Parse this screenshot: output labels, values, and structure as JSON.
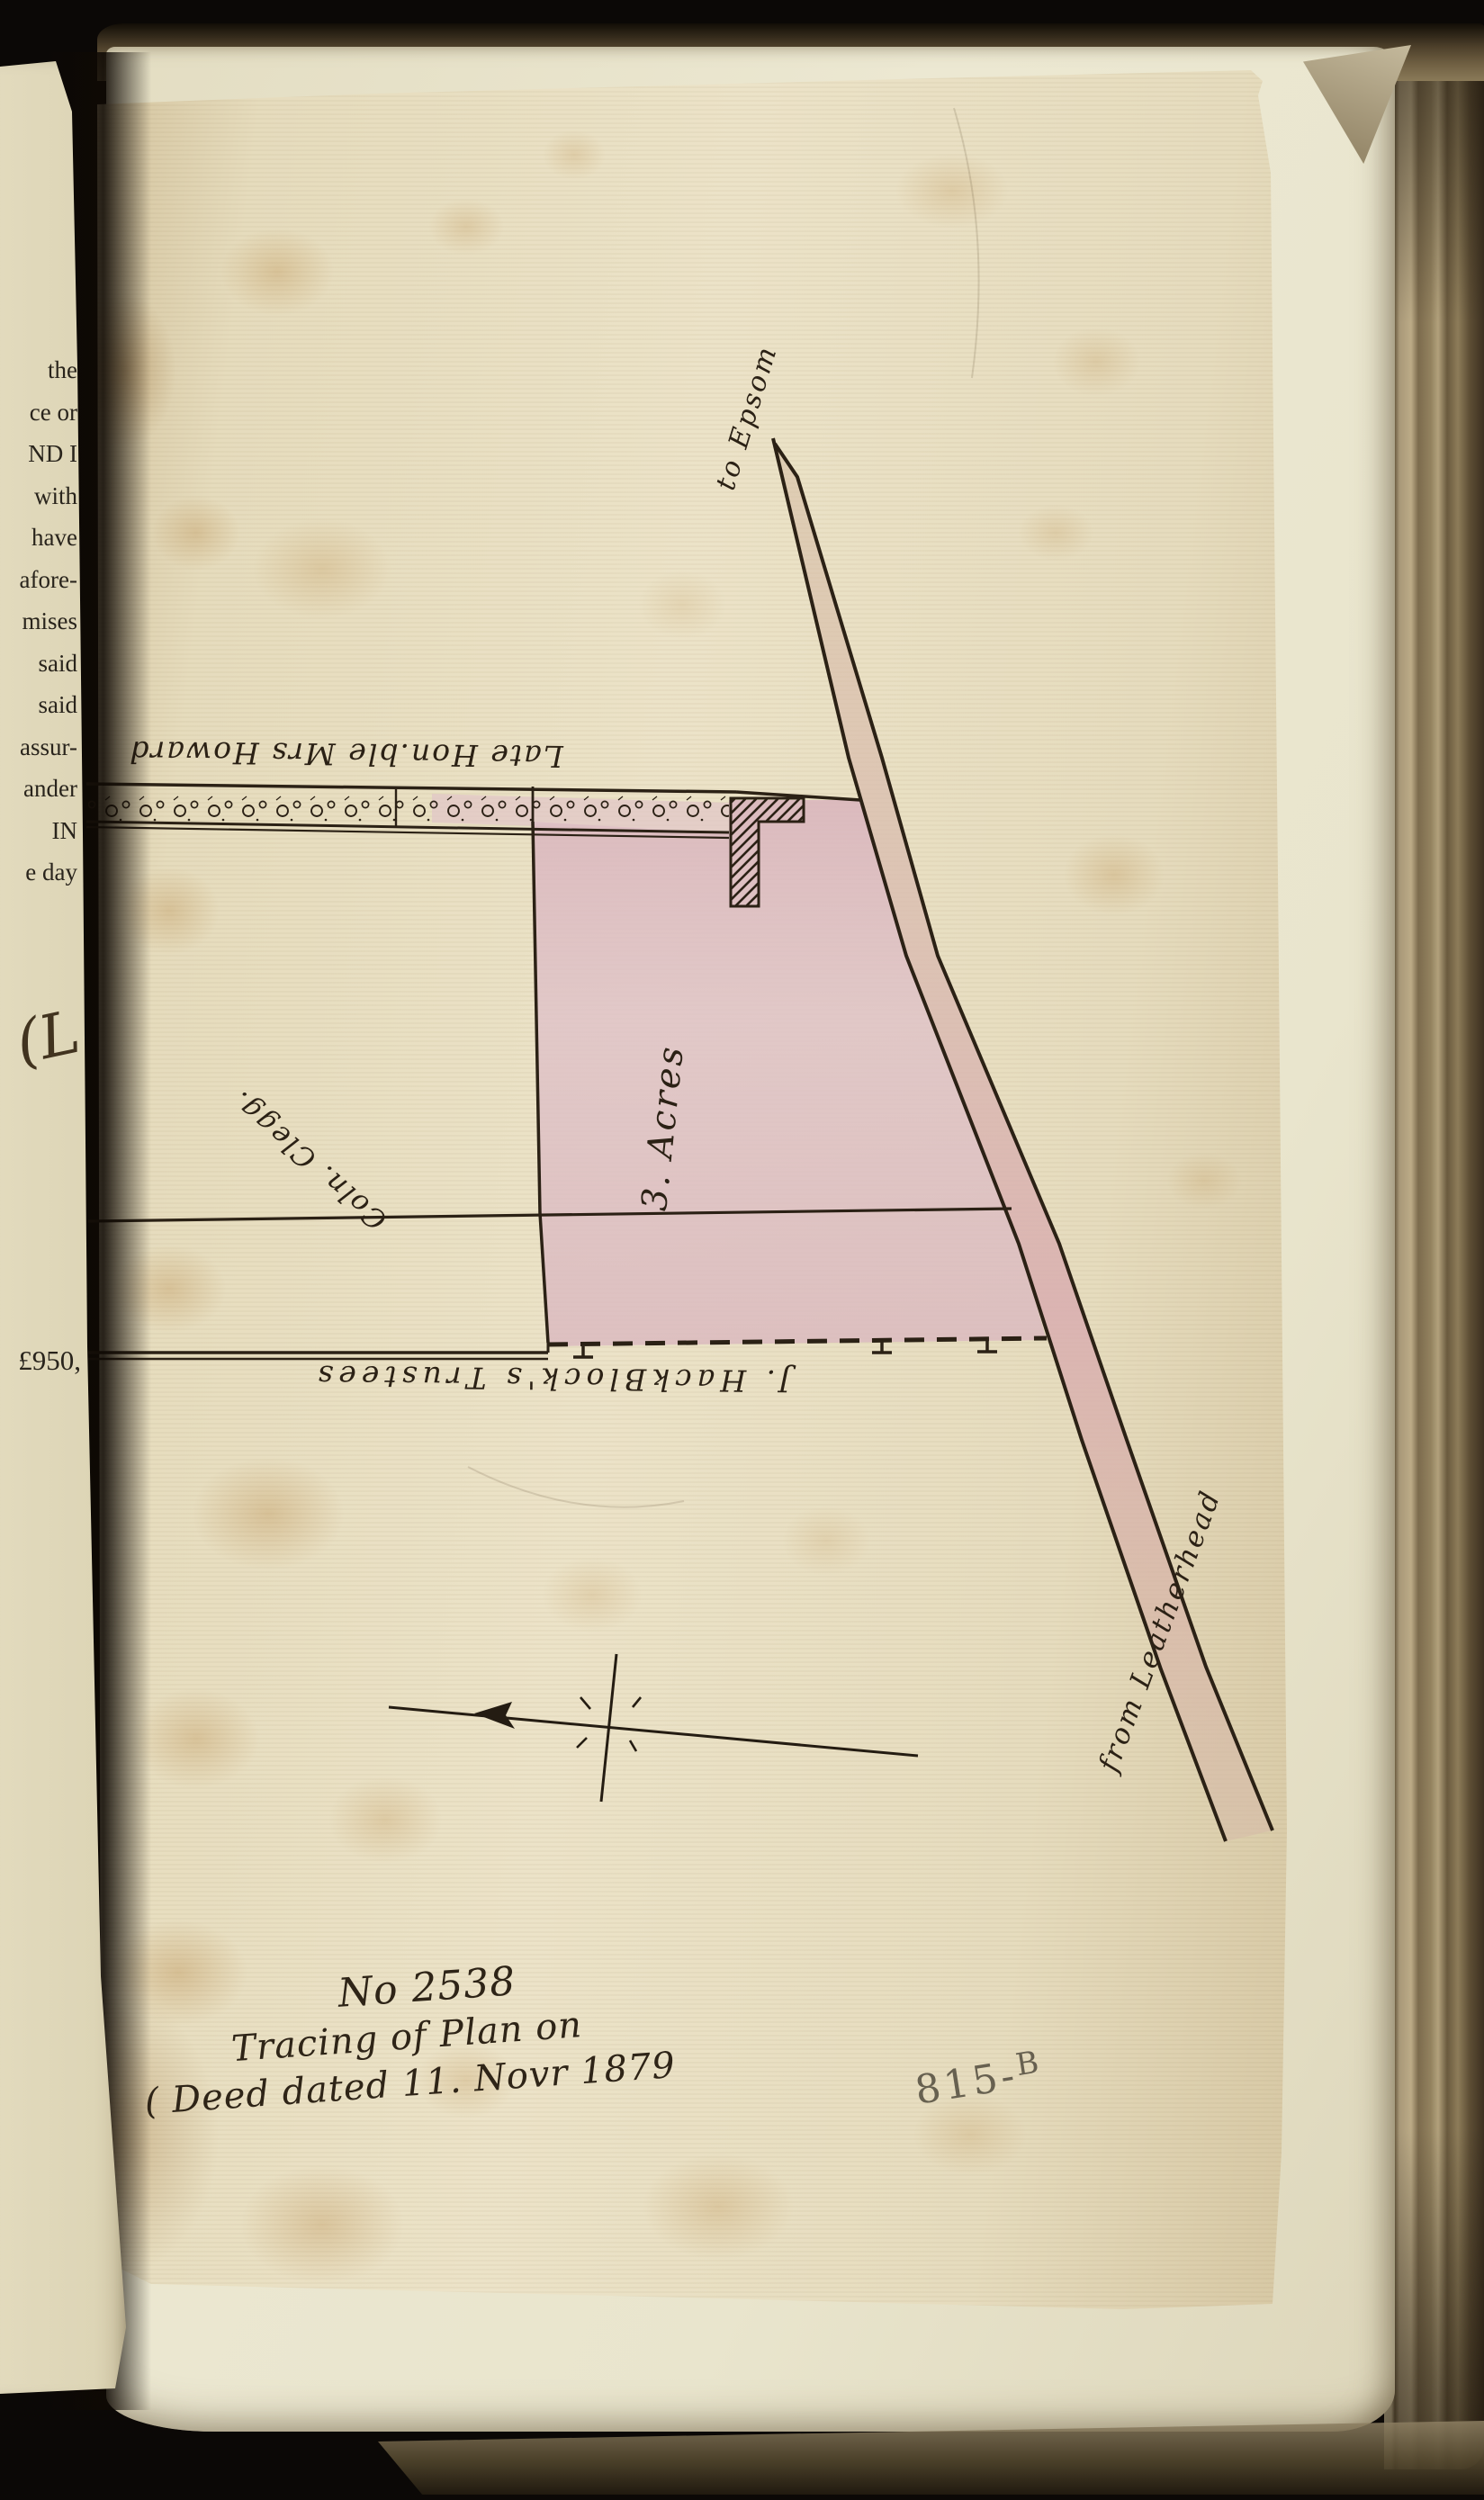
{
  "book": {
    "left_page_fragments": [
      "the",
      "ce or",
      "ND I",
      "with",
      "have",
      "afore-",
      "mises",
      "said",
      "said",
      "assur-",
      "ander",
      "IN",
      "e day"
    ],
    "left_page_amount": "£950,",
    "left_page_signature": "(L."
  },
  "plan": {
    "road_label_top": "to Epsom",
    "road_label_bottom": "from Leatherhead",
    "north_boundary_owner": "Late Hon.ble Mrs Howard",
    "west_boundary_owner": "Coln. Clegg.",
    "south_boundary_owner": "J. HackBlock's Trustees",
    "area_label": "3. Acres",
    "colors": {
      "plot_fill": "#dcbec4",
      "road_fill": "#d8bcae",
      "ink": "#2b2115",
      "paper": "#e8dfc2"
    }
  },
  "inscription": {
    "line1": "No 2538",
    "line2": "Tracing of Plan on",
    "line3": "( Deed dated 11. Novr 1879"
  },
  "reference": {
    "number": "815-",
    "suffix": "B"
  }
}
